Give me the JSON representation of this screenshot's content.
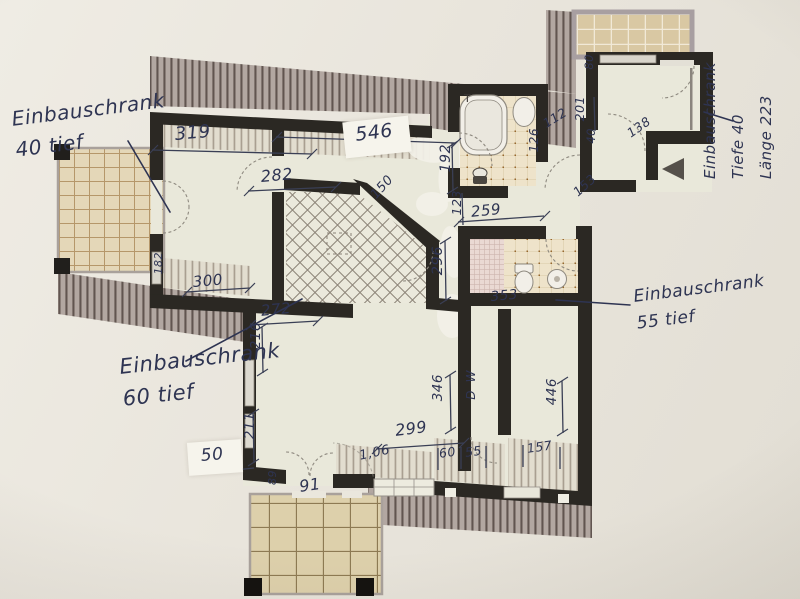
{
  "notes": {
    "closet40": {
      "l1": "Einbauschrank",
      "l2": "40 tief"
    },
    "closet60": {
      "l1": "Einbauschrank",
      "l2": "60 tief"
    },
    "closet55": {
      "l1": "Einbauschrank",
      "l2": "55 tief"
    },
    "closet223": {
      "l1": "Einbauschrank",
      "l2": "Tiefe 40",
      "l3": "Länge 223"
    }
  },
  "dims": {
    "d319": "319",
    "d546": "546",
    "d282": "282",
    "d150": "150",
    "d192": "192",
    "d112": "112",
    "d126": "126",
    "d123": "123",
    "d259": "259",
    "d296": "296",
    "d353": "353",
    "d272": "272",
    "d216": "216",
    "d300": "300",
    "d182": "182",
    "d211": "211",
    "d50": "50",
    "d89": "89",
    "d91": "91",
    "d299": "299",
    "d106": "1,06",
    "d60": "60",
    "d55": "55",
    "d157": "157",
    "d346": "346",
    "d446": "446",
    "d80": "80",
    "d201": "201",
    "d40": "40",
    "d138": "138",
    "d153": "153"
  },
  "labels": {
    "tub_faucet": "T",
    "washer": "W",
    "dryer": "D"
  },
  "colors": {
    "ink": "#2e3452",
    "wall": "#2b2823",
    "roof_hatch": "#b2a7a1",
    "paper": "#e9e5dc",
    "floor": "#e9e8da",
    "terrace_tile": "#e0d2ae"
  }
}
